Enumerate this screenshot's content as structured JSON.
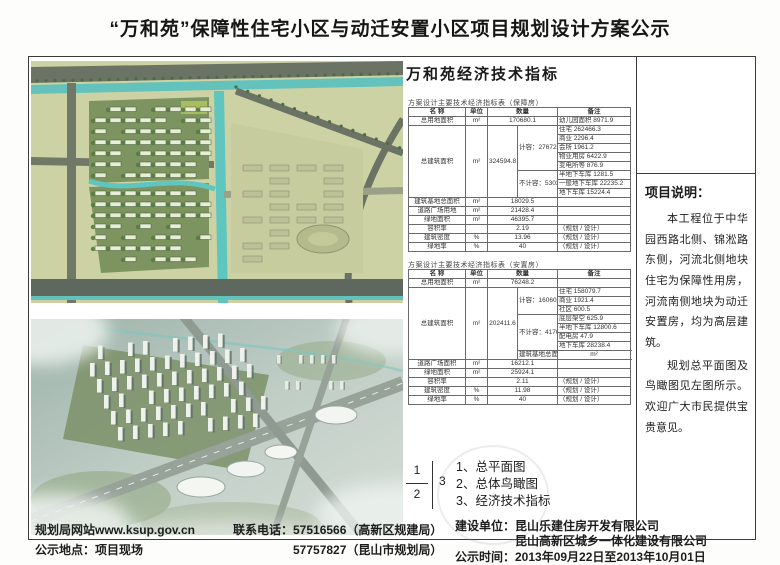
{
  "title": "“万和苑”保障性住宅小区与动迁安置小区项目规划设计方案公示",
  "watermark": {
    "text_primary": "WWW.KUNSHAN.M",
    "text_secondary": "KUNSHAN"
  },
  "indicators": {
    "heading": "万和苑经济技术指标",
    "table_baozhang": {
      "caption": "方案设计主要技术经济指标表（保障房）",
      "rows": [
        [
          {
            "t": "名  称"
          },
          {
            "t": "单位"
          },
          {
            "t": "数量",
            "cs": 2
          },
          {
            "t": "备注"
          }
        ],
        [
          {
            "t": "总用地面积"
          },
          {
            "t": "m²"
          },
          {
            "t": "170680.1",
            "cs": 2
          },
          {
            "t": "幼儿园面积 8971.9",
            "cls": "l"
          }
        ],
        [
          {
            "t": "总建筑面积",
            "rs": 8
          },
          {
            "t": "m²",
            "rs": 8
          },
          {
            "t": "324594.8",
            "rs": 8
          },
          {
            "t": "计容：276727.3",
            "rs": 5
          },
          {
            "t": "住宅 262466.3",
            "cls": "l"
          }
        ],
        [
          {
            "t": "商业 2296.4",
            "cls": "l"
          }
        ],
        [
          {
            "t": "会所 1961.2",
            "cls": "l"
          }
        ],
        [
          {
            "t": "物业用房 6422.9",
            "cls": "l"
          }
        ],
        [
          {
            "t": "变电所等 876.9",
            "cls": "l"
          }
        ],
        [
          {
            "t": "不计容：53036.3",
            "rs": 3
          },
          {
            "t": "半地下车库 1281.5",
            "cls": "l"
          }
        ],
        [
          {
            "t": "一般地下车库 22235.2",
            "cls": "l"
          }
        ],
        [
          {
            "t": "地下车库 15224.4",
            "cls": "l"
          }
        ],
        [
          {
            "t": "建筑基地总面积"
          },
          {
            "t": "m²"
          },
          {
            "t": "18029.5",
            "cs": 2
          },
          {
            "t": ""
          }
        ],
        [
          {
            "t": "道路广场用地"
          },
          {
            "t": "m²"
          },
          {
            "t": "21428.4",
            "cs": 2
          },
          {
            "t": ""
          }
        ],
        [
          {
            "t": "绿地面积"
          },
          {
            "t": "m²"
          },
          {
            "t": "46395.7",
            "cs": 2
          },
          {
            "t": ""
          }
        ],
        [
          {
            "t": "容积率"
          },
          {
            "t": ""
          },
          {
            "t": "2.19",
            "cs": 2
          },
          {
            "t": "（规划 / 设计）",
            "cls": "l"
          }
        ],
        [
          {
            "t": "建筑密度"
          },
          {
            "t": "%"
          },
          {
            "t": "13.96",
            "cs": 2
          },
          {
            "t": "（规划 / 设计）",
            "cls": "l"
          }
        ],
        [
          {
            "t": "绿地率"
          },
          {
            "t": "%"
          },
          {
            "t": "40",
            "cs": 2
          },
          {
            "t": "（规划 / 设计）",
            "cls": "l"
          }
        ]
      ]
    },
    "table_anzhi": {
      "caption": "方案设计主要技术经济指标表（安置房）",
      "rows": [
        [
          {
            "t": "名  称"
          },
          {
            "t": "单位"
          },
          {
            "t": "数量",
            "cs": 2
          },
          {
            "t": "备注"
          }
        ],
        [
          {
            "t": "总用地面积"
          },
          {
            "t": "m²"
          },
          {
            "t": "76248.2",
            "cs": 2
          },
          {
            "t": ""
          }
        ],
        [
          {
            "t": "总建筑面积",
            "rs": 8
          },
          {
            "t": "m²",
            "rs": 8
          },
          {
            "t": "202411.6",
            "rs": 8
          },
          {
            "t": "计容：160602.9",
            "rs": 3
          },
          {
            "t": "住宅 158079.7",
            "cls": "l"
          }
        ],
        [
          {
            "t": "商业 1921.4",
            "cls": "l"
          }
        ],
        [
          {
            "t": "社区 600.5",
            "cls": "l"
          }
        ],
        [
          {
            "t": "不计容：41703.1",
            "rs": 4
          },
          {
            "t": "底层架空 625.9",
            "cls": "l"
          }
        ],
        [
          {
            "t": "半地下车库 12800.6",
            "cls": "l"
          }
        ],
        [
          {
            "t": "配电房 47.9",
            "cls": "l"
          }
        ],
        [
          {
            "t": "地下车库 28238.4",
            "cls": "l"
          }
        ],
        [
          {
            "t": "建筑基地总面积"
          },
          {
            "t": "m²"
          },
          {
            "t": "9011.9",
            "cs": 2
          },
          {
            "t": ""
          }
        ],
        [
          {
            "t": "道路广场面积"
          },
          {
            "t": "m²"
          },
          {
            "t": "16212.1",
            "cs": 2
          },
          {
            "t": ""
          }
        ],
        [
          {
            "t": "绿地面积"
          },
          {
            "t": "m²"
          },
          {
            "t": "25924.1",
            "cs": 2
          },
          {
            "t": ""
          }
        ],
        [
          {
            "t": "容积率"
          },
          {
            "t": ""
          },
          {
            "t": "2.11",
            "cs": 2
          },
          {
            "t": "（规划 / 设计）",
            "cls": "l"
          }
        ],
        [
          {
            "t": "建筑密度"
          },
          {
            "t": "%"
          },
          {
            "t": "11.98",
            "cs": 2
          },
          {
            "t": "（规划 / 设计）",
            "cls": "l"
          }
        ],
        [
          {
            "t": "绿地率"
          },
          {
            "t": "%"
          },
          {
            "t": "40",
            "cs": 2
          },
          {
            "t": "（规划 / 设计）",
            "cls": "l"
          }
        ]
      ]
    }
  },
  "sheet_index": {
    "top": "1",
    "bottom": "2",
    "side": "3"
  },
  "legend_items": [
    "1、总平面图",
    "2、总体鸟瞰图",
    "3、经济技术指标"
  ],
  "project_note": {
    "title": "项目说明：",
    "paragraphs": [
      "本工程位于中华园西路北侧、锦淞路东侧，河流北侧地块住宅为保障性用房，河流南侧地块为动迁安置房，均为高层建筑。",
      "规划总平面图及鸟瞰图见左图所示。欢迎广大市民提供宝贵意见。"
    ]
  },
  "footer": {
    "website": "规划局网站www.ksup.gov.cn",
    "location": "公示地点：项目现场",
    "phone1": "联系电话：57516566（高新区规建局）",
    "phone2": "57757827（昆山市规划局）",
    "builder1": "建设单位：昆山乐建住房开发有限公司",
    "builder2": "昆山高新区城乡一体化建设有限公司",
    "period": "公示时间：2013年09月22日至2013年10月01日"
  },
  "colors": {
    "canal_teal": "#5ec5bf",
    "road_gray": "#6b7365",
    "plan_ground": "#ccd2a4",
    "parcel_green": "#7e9460",
    "aerial_haze": "#a9bdb4"
  }
}
